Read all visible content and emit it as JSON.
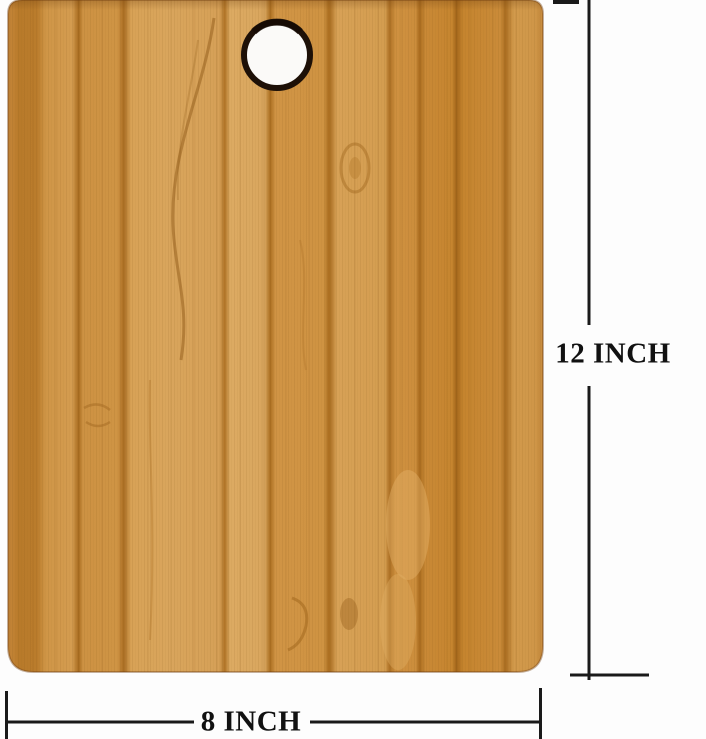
{
  "image": {
    "subject": "Bamboo wooden cutting board (portrait orientation) with a round hanging hole at top center, annotated with size dimensions",
    "background_color": "#fdfdfd"
  },
  "board": {
    "material": "bamboo, vertical grain planks",
    "hole_position": "top center",
    "colors": {
      "wood_base": "#d09646",
      "wood_light": "#dcaa62",
      "wood_dark": "#b87a2c",
      "plank_seam": "#a96c1f",
      "hole_ring": "#1d1007",
      "hole_fill": "#fbfaf8"
    }
  },
  "annotations": {
    "height_label": "12 INCH",
    "width_label": "8 INCH",
    "line_color": "#1a1a1a",
    "label_color": "#111111"
  }
}
